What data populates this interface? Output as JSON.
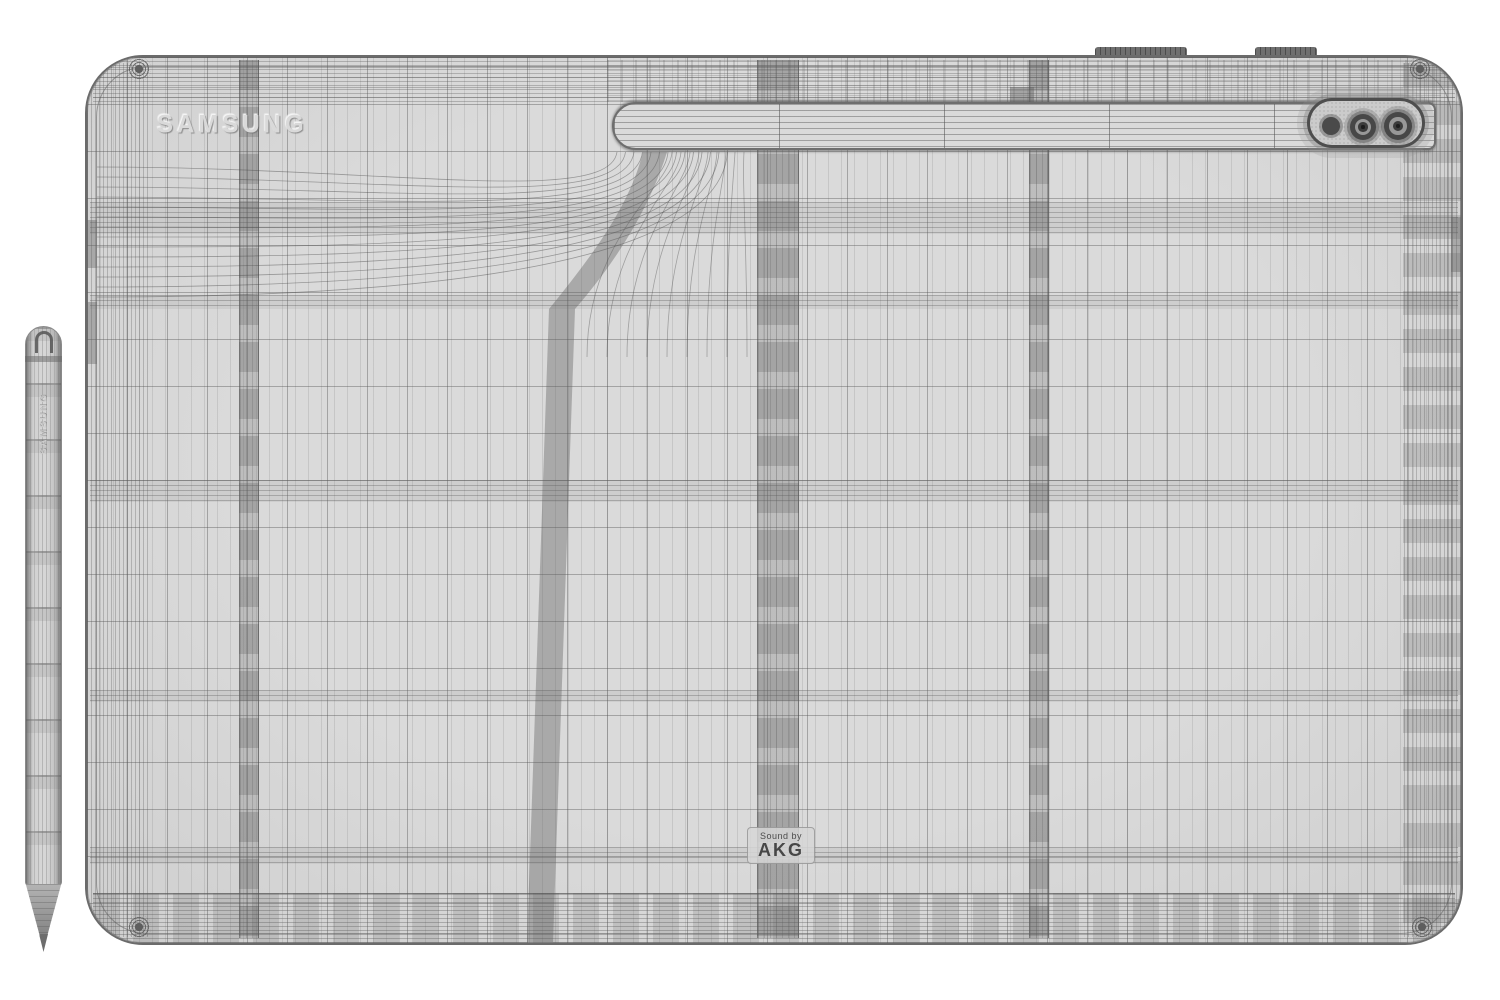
{
  "scene": {
    "background_color": "#ffffff",
    "description": "3D wireframe render, rear view of a Samsung tablet with S Pen stylus"
  },
  "tablet": {
    "brand_logo": "SAMSUNG",
    "audio_label_line1": "Sound by",
    "audio_label_line2": "AKG",
    "body_color": "#d9d9d9",
    "mesh_line_color": "#8b8b8b",
    "antenna_band_color": "#9b9b9b",
    "camera": {
      "flash_color": "#4a4a4a",
      "lens_ring_color": "#474747",
      "module_border_color": "#4e4e4e"
    }
  },
  "stylus": {
    "brand_logo": "SAMSUNG",
    "body_color": "#d6d6d6"
  }
}
